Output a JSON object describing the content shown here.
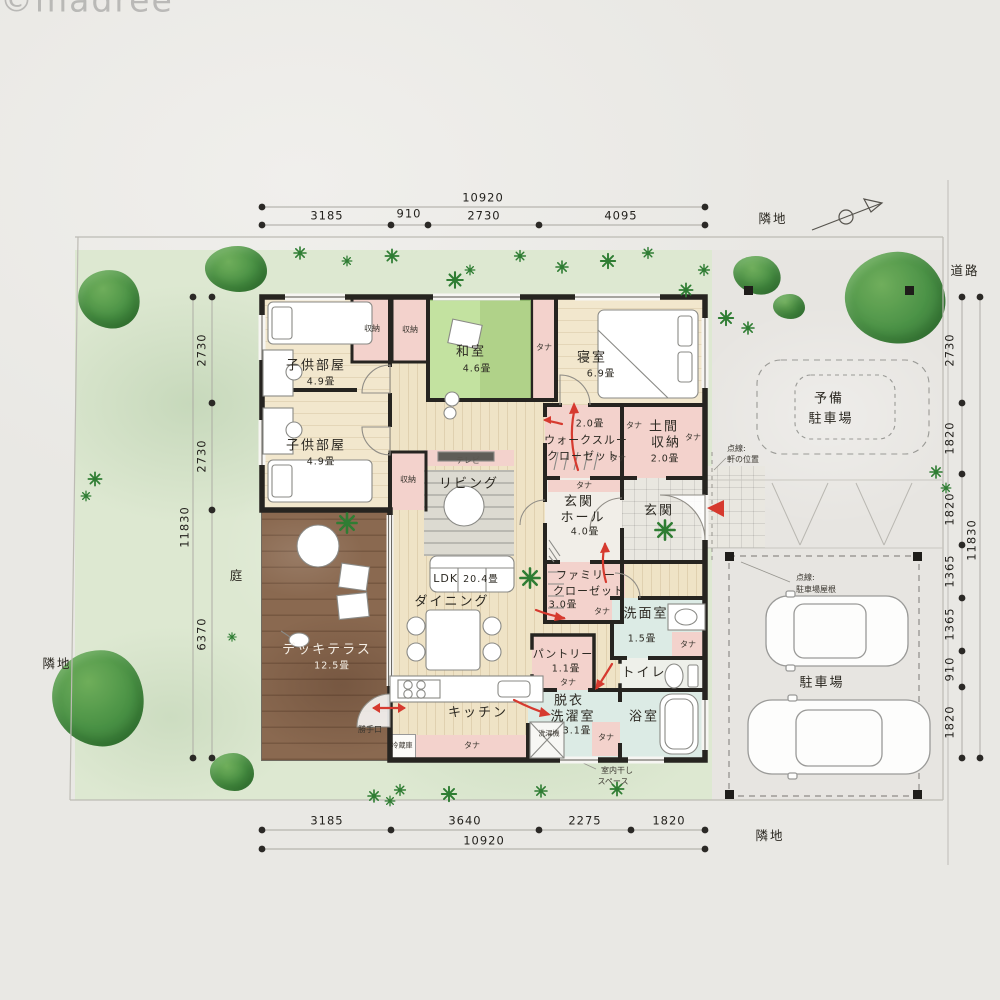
{
  "watermark": "©madree",
  "site": {
    "garden_label": "庭",
    "neighbor_top": "隣地",
    "neighbor_bottom": "隣地",
    "neighbor_left": "隣地",
    "road": "道路"
  },
  "dims": {
    "top": {
      "total": "10920",
      "segments": [
        "3185",
        "910",
        "2730",
        "4095"
      ]
    },
    "bottom": {
      "total": "10920",
      "segments": [
        "3185",
        "3640",
        "2275",
        "1820"
      ]
    },
    "left": {
      "total": "11830",
      "segments": [
        "2730",
        "2730",
        "6370"
      ]
    },
    "right": {
      "total": "11830",
      "segments": [
        "2730",
        "1820",
        "1820",
        "1365",
        "1365",
        "910",
        "1820"
      ]
    }
  },
  "annotations": {
    "eaves_line1": "点線:",
    "eaves_line2": "軒の位置",
    "roof_line1": "点線:",
    "roof_line2": "駐車場屋根",
    "indoor_dry_line1": "室内干し",
    "indoor_dry_line2": "スペース"
  },
  "parking": {
    "spare_line1": "予備",
    "spare_line2": "駐車場",
    "main": "駐車場"
  },
  "rooms": {
    "kids1": {
      "name": "子供部屋",
      "size": "4.9畳"
    },
    "kids2": {
      "name": "子供部屋",
      "size": "4.9畳"
    },
    "washitsu": {
      "name": "和室",
      "size": "4.6畳"
    },
    "bedroom": {
      "name": "寝室",
      "size": "6.9畳"
    },
    "wtc": {
      "size": "2.0畳",
      "line1": "ウォークスルー",
      "line2": "クローゼット"
    },
    "doma": {
      "line1": "土間",
      "line2": "収納",
      "size": "2.0畳"
    },
    "hall": {
      "line1": "玄関",
      "line2": "ホール",
      "size": "4.0畳"
    },
    "genkan": {
      "name": "玄関"
    },
    "famclo": {
      "line1": "ファミリー",
      "line2": "クローゼット",
      "size": "3.0畳"
    },
    "living": {
      "name": "リビング"
    },
    "ldk": {
      "name": "LDK",
      "size": "20.4畳"
    },
    "dining": {
      "name": "ダイニング"
    },
    "kitchen": {
      "name": "キッチン"
    },
    "deck": {
      "name": "デッキテラス",
      "size": "12.5畳"
    },
    "pantry": {
      "name": "パントリー",
      "size": "1.1畳"
    },
    "senmen": {
      "name": "洗面室",
      "size": "1.5畳"
    },
    "toilet": {
      "name": "トイレ"
    },
    "bath": {
      "name": "浴室"
    },
    "datsui": {
      "line1": "脱衣",
      "line2": "洗濯室",
      "size": "3.1畳"
    }
  },
  "fixtures": {
    "tana": "タナ",
    "shuno": "収納",
    "tv": "テレビ",
    "fridge": "冷蔵庫",
    "washer": "洗濯機",
    "katteguchi": "勝手口"
  },
  "colors": {
    "tatami": "#b9dd90",
    "deck": "#8a6950",
    "closet_pink": "#f3d2cc",
    "wet_blue": "#dcebe5",
    "garden": "#dde8d1",
    "wall": "#262420",
    "arrow_red": "#d63a2f",
    "wood": "#efe3c6"
  }
}
